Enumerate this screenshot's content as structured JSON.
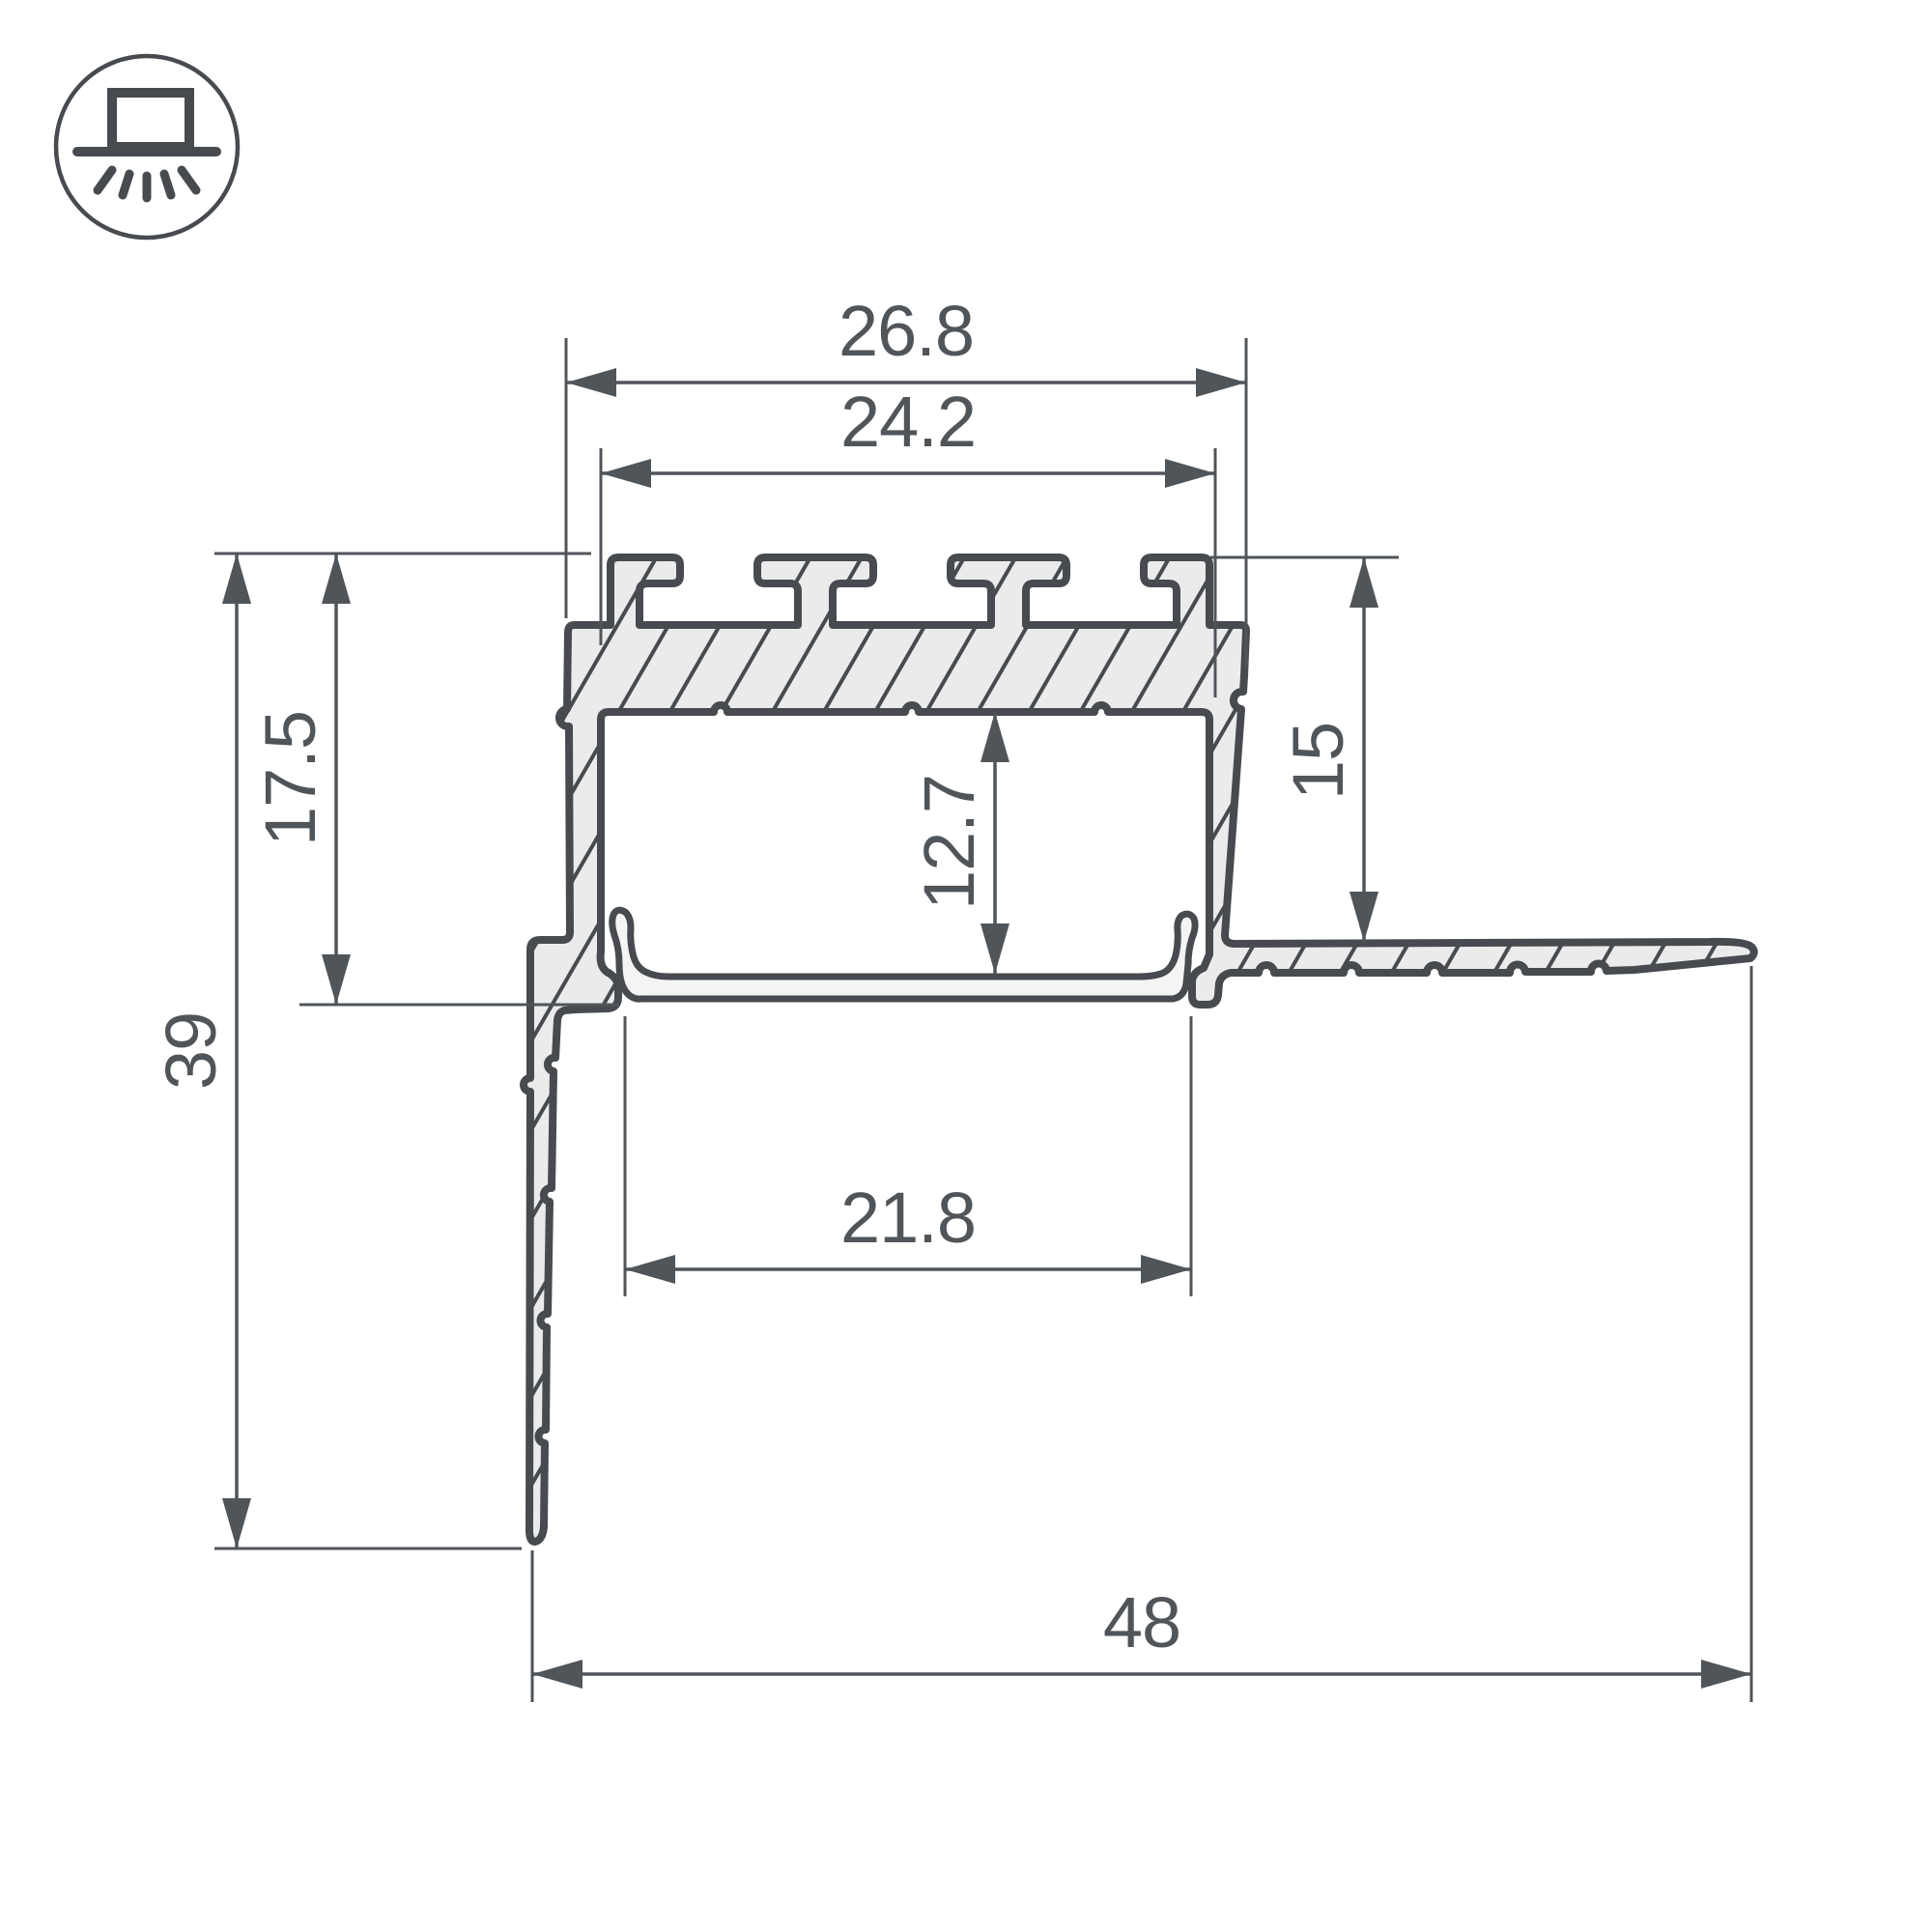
{
  "drawing": {
    "type": "led-profile-cross-section-technical-drawing",
    "icon": {
      "name": "recessed-mount-light-icon"
    },
    "colors": {
      "background": "#ffffff",
      "line": "#474b50",
      "dim": "#50555a",
      "fill": "#ebebec",
      "diffuser_fill": "#f4f4f5"
    },
    "dims": {
      "top_outer_width": "26.8",
      "top_inner_width": "24.2",
      "opening_width": "21.8",
      "total_width": "48",
      "total_height": "39",
      "recess_height": "17.5",
      "inner_height": "12.7",
      "flange_side_height": "15"
    }
  }
}
